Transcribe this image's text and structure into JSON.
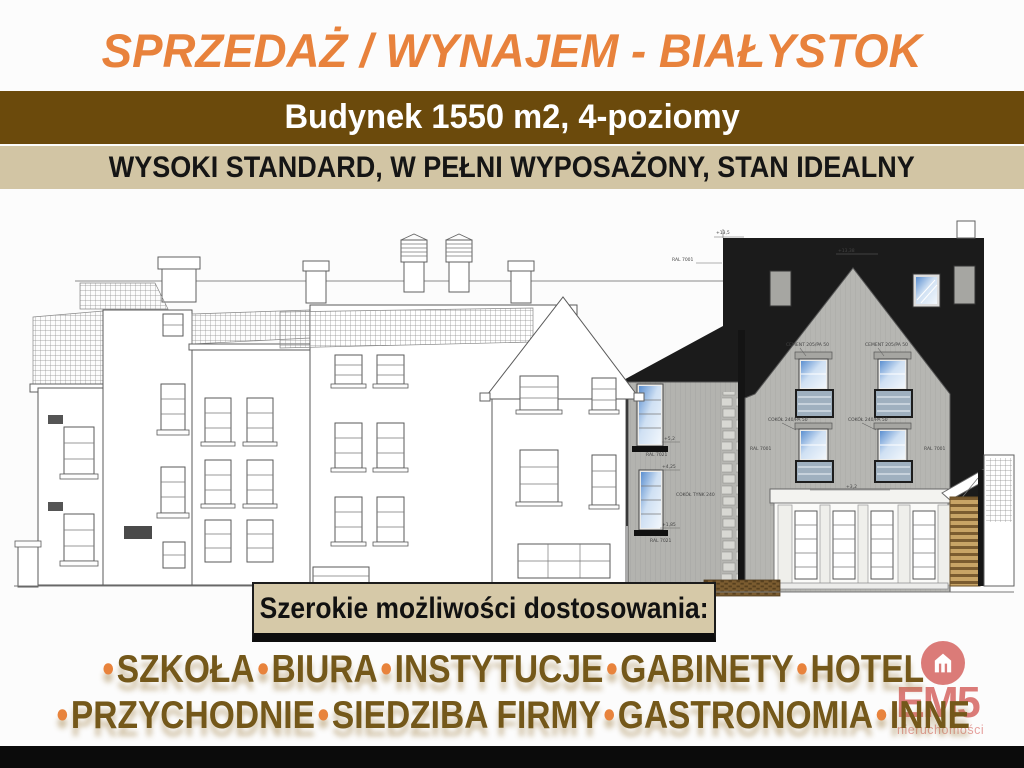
{
  "header": {
    "title": "SPRZEDAŻ / WYNAJEM - BIAŁYSTOK",
    "color": "#E8823C"
  },
  "bands": {
    "building_info": {
      "label": "Budynek 1550 m2, 4-poziomy",
      "background": "#6B4A0C",
      "text_color": "#FFFFFF"
    },
    "standard": {
      "label": "WYSOKI STANDARD, W PEŁNI WYPOSAŻONY, STAN IDEALNY",
      "background": "#D2C5A4",
      "text_color": "#151515"
    }
  },
  "banner": {
    "label": "Szerokie możliwości dostosowania:",
    "background": "#D6C9A8",
    "text_color": "#111111"
  },
  "uses": {
    "bullet": "•",
    "line1": [
      "SZKOŁA",
      "BIURA",
      "INSTYTUCJE",
      "GABINETY",
      "HOTEL"
    ],
    "line2": [
      "PRZYCHODNIE",
      "SIEDZIBA FIRMY",
      "GASTRONOMIA",
      "INNE"
    ],
    "text_color": "#74581A",
    "bullet_color": "#E8833C"
  },
  "logo": {
    "name": "EM5",
    "subtitle": "nieruchomości",
    "color": "#DB7B78",
    "subtitle_color": "#E6A19E"
  },
  "drawing": {
    "annotations": {
      "lvl_135": "+13,5",
      "lvl_1338": "+13,38",
      "ral7001": "RAL 7001",
      "ral7021": "RAL 7021",
      "lvl_52": "+5,2",
      "lvl_425": "+4,25",
      "lvl_185": "+1,85",
      "lvl_32": "+3,2",
      "cement": "CEMENT 205/PA 50",
      "cokol": "COKÓŁ 240/PA 50",
      "cokol_tynk": "COKÓŁ TYNK 240"
    }
  }
}
